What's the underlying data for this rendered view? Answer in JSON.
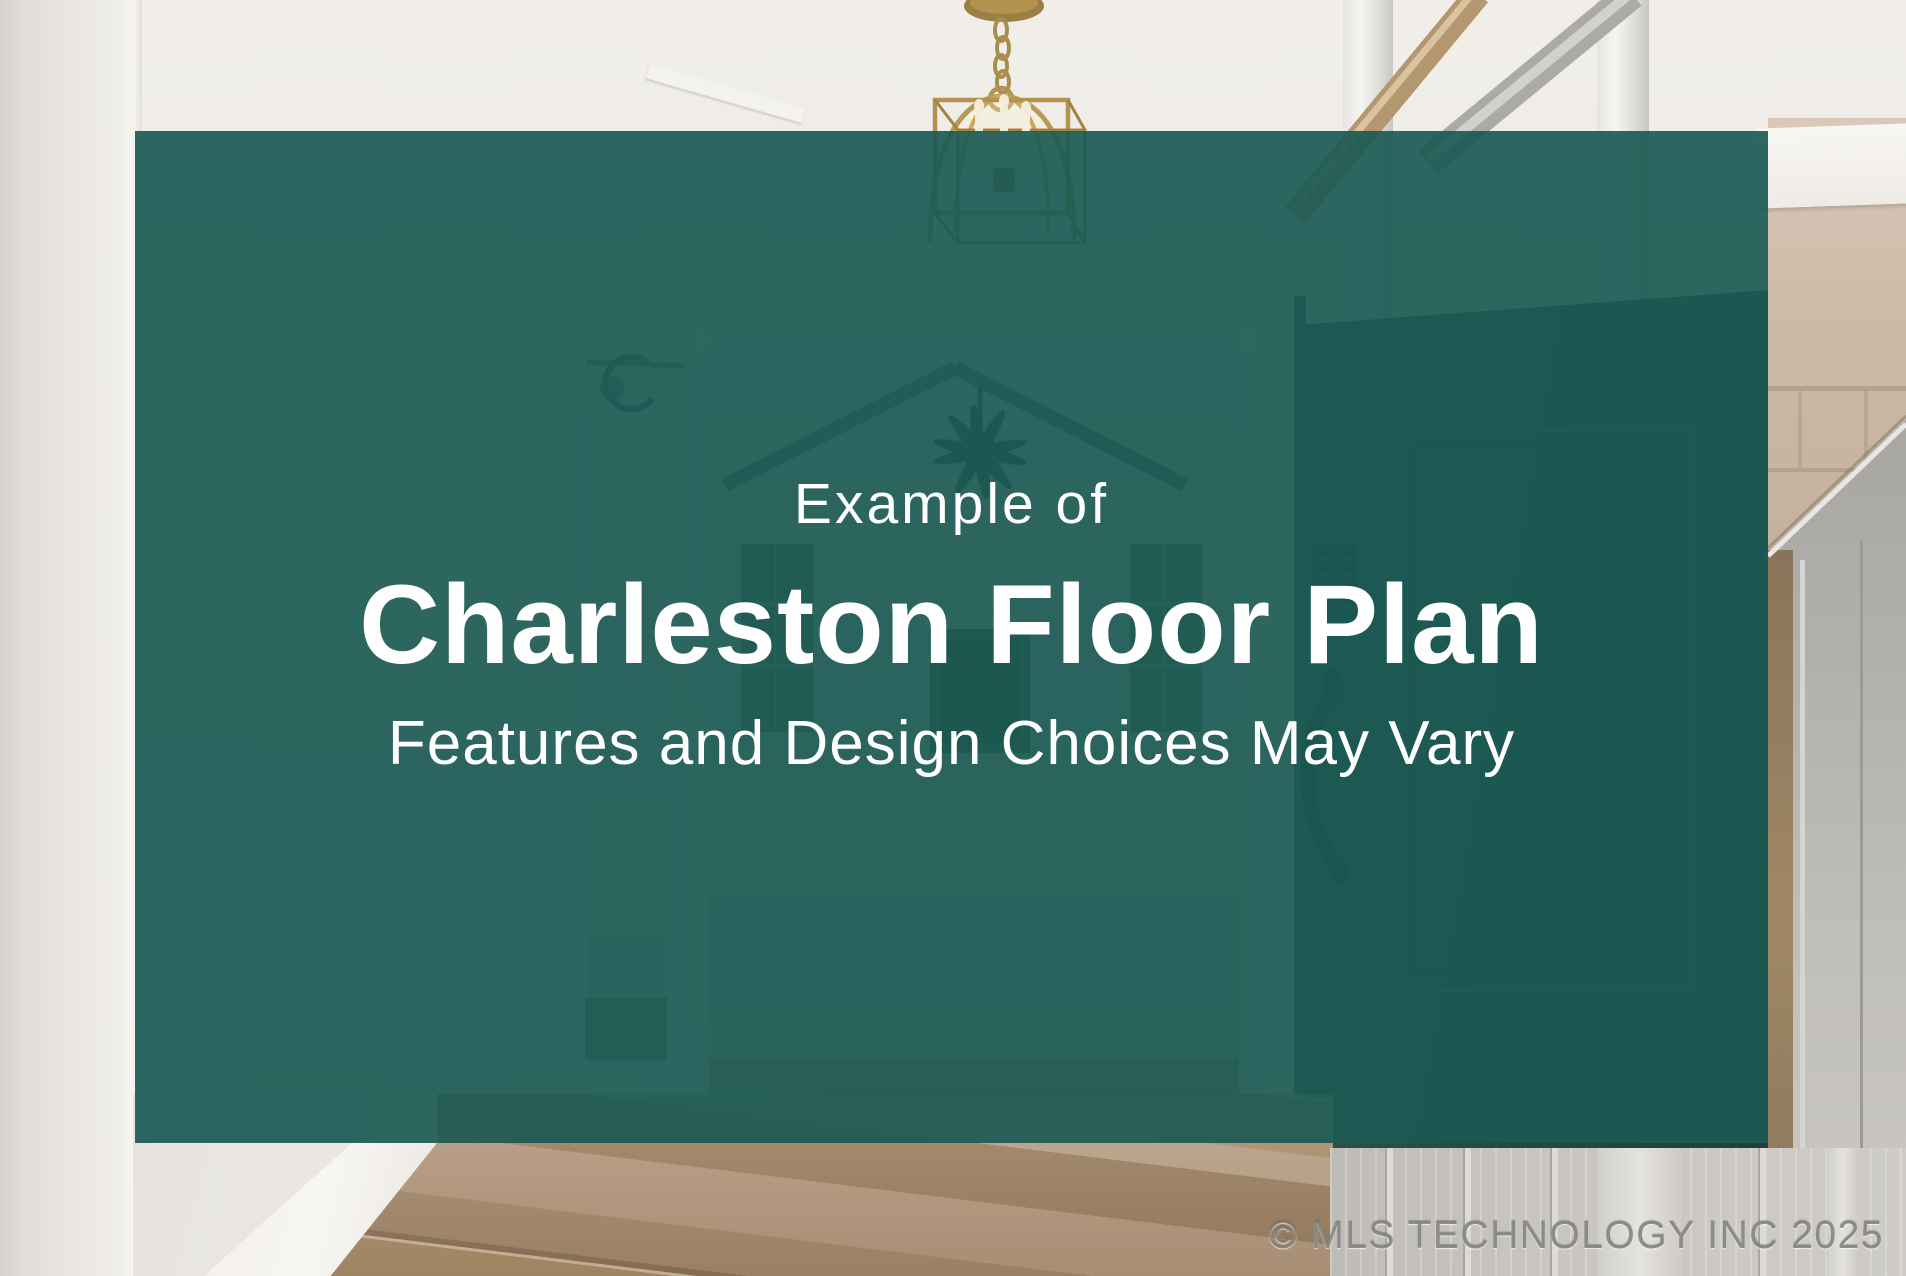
{
  "page": {
    "kind": "real-estate-listing-photo-card",
    "width_px": 1906,
    "height_px": 1276
  },
  "card": {
    "kicker": "Example of",
    "title": "Charleston Floor Plan",
    "subtitle": "Features and Design Choices May Vary"
  },
  "watermark": {
    "text": "© MLS TECHNOLOGY INC 2025"
  },
  "colors": {
    "overlay_teal": "rgba(27,90,84,0.92)",
    "card_text": "#ffffff",
    "watermark_gray": "#7d7c78",
    "wall_cream": "#edeae5",
    "chandelier_gold": "#b3924f",
    "wood_floor_tan": "#a3876a",
    "front_door_dark_green": "#2d4945",
    "gray_door": "#b7b5b1",
    "beige_wall": "#cdbaa8"
  },
  "scene": {
    "description": "entry hallway photo behind teal overlay",
    "elements": [
      "gold-lantern-chandelier",
      "hallway-left-doorway-with-sconce",
      "vaulted-great-room-opening",
      "ceiling-fan",
      "fireplace-with-mantel",
      "dark-green-open-front-door-with-keypad-and-pull-handle",
      "hardwood-floor",
      "white-baseboard",
      "gray-panel-door",
      "beige-side-wall"
    ]
  }
}
